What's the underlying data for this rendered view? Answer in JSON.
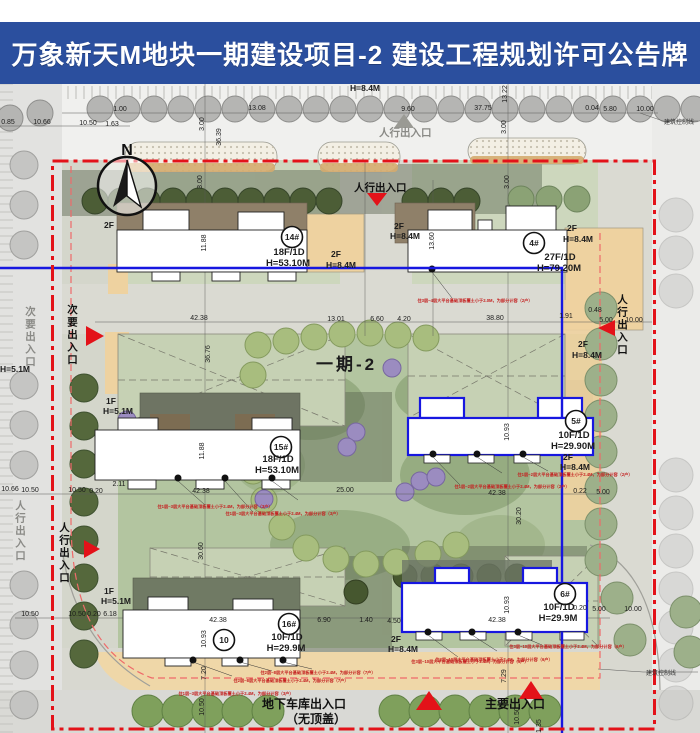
{
  "header": {
    "title": "万象新天M地块一期建设项目-2  建设工程规划许可公告牌"
  },
  "plan": {
    "phase_label": "一期-2",
    "north_label": "N",
    "colors": {
      "header_bg": "#2b4f9e",
      "boundary_red": "#e31219",
      "phase_blue": "#1717e0",
      "note_red": "#c42020",
      "tree_green": "#4c5d36",
      "annex_tan": "#eed2a0"
    },
    "buildings": [
      {
        "num": "14#",
        "floors": "18F/1D",
        "height": "H=53.10M",
        "cx": 292,
        "cy": 237,
        "tx": 289,
        "ty": 255
      },
      {
        "num": "4#",
        "floors": "27F/1D",
        "height": "H=79.20M",
        "cx": 534,
        "cy": 243,
        "tx": 560,
        "ty": 260
      },
      {
        "num": "15#",
        "floors": "18F/1D",
        "height": "H=53.10M",
        "cx": 281,
        "cy": 447,
        "tx": 278,
        "ty": 462
      },
      {
        "num": "5#",
        "floors": "10F/1D",
        "height": "H=29.90M",
        "cx": 576,
        "cy": 421,
        "tx": 574,
        "ty": 438
      },
      {
        "num": "16#",
        "floors": "10F/1D",
        "height": "H=29.9M",
        "cx": 289,
        "cy": 624,
        "tx": 287,
        "ty": 640
      },
      {
        "num": "10",
        "floors": "",
        "height": "",
        "cx": 224,
        "cy": 640,
        "tx": 0,
        "ty": 0
      },
      {
        "num": "6#",
        "floors": "10F/1D",
        "height": "H=29.9M",
        "cx": 565,
        "cy": 594,
        "tx": 559,
        "ty": 610
      }
    ],
    "unit_labels": [
      [
        "2F",
        104,
        228
      ],
      [
        "2F",
        331,
        257
      ],
      [
        "H=8.4M",
        326,
        268
      ],
      [
        "2F",
        394,
        229
      ],
      [
        "H=8.4M",
        390,
        239
      ],
      [
        "2F",
        567,
        231
      ],
      [
        "H=8.4M",
        563,
        242
      ],
      [
        "H=8.4M",
        350,
        91
      ],
      [
        "2F",
        578,
        347
      ],
      [
        "H=8.4M",
        572,
        358
      ],
      [
        "1F",
        106,
        404
      ],
      [
        "H=5.1M",
        103,
        414
      ],
      [
        "1F",
        104,
        594
      ],
      [
        "H=5.1M",
        101,
        604
      ],
      [
        "2F",
        391,
        642
      ],
      [
        "H=8.4M",
        388,
        652
      ],
      [
        "2F",
        563,
        460
      ],
      [
        "H=8.4M",
        560,
        470
      ],
      [
        "H=5.1M",
        0,
        372
      ]
    ],
    "dimensions": [
      [
        "0.85",
        8,
        124,
        0
      ],
      [
        "10.66",
        42,
        124,
        0
      ],
      [
        "10.50",
        88,
        125,
        0
      ],
      [
        "1.63",
        112,
        126,
        0
      ],
      [
        "1.00",
        120,
        111,
        0
      ],
      [
        "13.08",
        257,
        110,
        0
      ],
      [
        "36.39",
        221,
        137,
        1
      ],
      [
        "3.00",
        204,
        124,
        1
      ],
      [
        "3.00",
        202,
        182,
        1
      ],
      [
        "9.60",
        408,
        111,
        0
      ],
      [
        "37.75",
        483,
        110,
        0
      ],
      [
        "13.22",
        507,
        94,
        1
      ],
      [
        "3.00",
        506,
        127,
        1
      ],
      [
        "3.00",
        509,
        182,
        1
      ],
      [
        "0.04",
        592,
        110,
        0
      ],
      [
        "5.80",
        610,
        111,
        0
      ],
      [
        "10.00",
        645,
        111,
        0
      ],
      [
        "42.38",
        199,
        320,
        0
      ],
      [
        "13.01",
        336,
        321,
        0
      ],
      [
        "6.60",
        377,
        321,
        0
      ],
      [
        "4.20",
        404,
        321,
        0
      ],
      [
        "38.80",
        495,
        320,
        0
      ],
      [
        "1.91",
        566,
        318,
        0
      ],
      [
        "0.48",
        595,
        312,
        0
      ],
      [
        "5.00",
        606,
        322,
        0
      ],
      [
        "10.00",
        634,
        322,
        0
      ],
      [
        "11.88",
        206,
        243,
        1
      ],
      [
        "13.60",
        434,
        241,
        1
      ],
      [
        "36.76",
        210,
        354,
        1
      ],
      [
        "11.88",
        204,
        451,
        1
      ],
      [
        "10.93",
        509,
        432,
        1
      ],
      [
        "10.66",
        10,
        491,
        0
      ],
      [
        "10.50",
        30,
        492,
        0
      ],
      [
        "10.50",
        77,
        492,
        0
      ],
      [
        "0.20",
        96,
        493,
        0
      ],
      [
        "2.11",
        119,
        486,
        0
      ],
      [
        "42.38",
        201,
        493,
        0
      ],
      [
        "25.00",
        345,
        492,
        0
      ],
      [
        "42.38",
        497,
        495,
        0
      ],
      [
        "0.22",
        580,
        493,
        0
      ],
      [
        "5.00",
        603,
        494,
        0
      ],
      [
        "30.20",
        521,
        516,
        1
      ],
      [
        "30.60",
        203,
        551,
        1
      ],
      [
        "10.50",
        30,
        616,
        0
      ],
      [
        "10.50",
        77,
        616,
        0
      ],
      [
        "0.20",
        94,
        616,
        0
      ],
      [
        "6.18",
        110,
        616,
        0
      ],
      [
        "42.38",
        218,
        622,
        0
      ],
      [
        "6.90",
        324,
        622,
        0
      ],
      [
        "1.40",
        366,
        622,
        0
      ],
      [
        "4.50",
        394,
        623,
        0
      ],
      [
        "42.38",
        497,
        622,
        0
      ],
      [
        "10.93",
        206,
        639,
        1
      ],
      [
        "10.93",
        509,
        605,
        1
      ],
      [
        "0.20",
        580,
        610,
        0
      ],
      [
        "5.00",
        599,
        611,
        0
      ],
      [
        "10.00",
        633,
        611,
        0
      ],
      [
        "7.20",
        206,
        673,
        1
      ],
      [
        "10.50",
        204,
        707,
        1
      ],
      [
        "7.29",
        506,
        676,
        1
      ],
      [
        "10.50",
        519,
        716,
        1
      ],
      [
        "1.35",
        541,
        726,
        1
      ]
    ],
    "entrances": [
      {
        "text": "人行出入口",
        "x": 379,
        "y": 136,
        "vertical": false,
        "muted": true,
        "size": 10.5
      },
      {
        "text": "人行出入口",
        "x": 354,
        "y": 191,
        "vertical": false,
        "muted": false,
        "size": 10.5
      },
      {
        "text": "次要出入口",
        "x": 30,
        "y": 306,
        "vertical": true,
        "muted": true,
        "size": 10.5
      },
      {
        "text": "次要出入口",
        "x": 72,
        "y": 304,
        "vertical": true,
        "muted": false,
        "size": 10.5
      },
      {
        "text": "人行出入口",
        "x": 20,
        "y": 500,
        "vertical": true,
        "muted": true,
        "size": 10.5
      },
      {
        "text": "人行出入口",
        "x": 64,
        "y": 522,
        "vertical": true,
        "muted": false,
        "size": 10.5
      },
      {
        "text": "人行出入口",
        "x": 622,
        "y": 294,
        "vertical": true,
        "muted": false,
        "size": 10.5
      },
      {
        "text": "地下车库出入口",
        "x": 262,
        "y": 708,
        "vertical": false,
        "muted": false,
        "size": 12
      },
      {
        "text": "（无顶盖）",
        "x": 286,
        "y": 723,
        "vertical": false,
        "muted": false,
        "size": 12
      },
      {
        "text": "主要出入口",
        "x": 485,
        "y": 708,
        "vertical": false,
        "muted": false,
        "size": 12
      }
    ],
    "red_notes": [
      {
        "x": 475,
        "y": 302,
        "text": "住3层~4层大平台基础顶板覆土小于2.0M，为部分计容（2户）"
      },
      {
        "x": 215,
        "y": 508,
        "text": "住1层~3层大平台基础顶板覆土小于2.4M，为部分计容（3户）"
      },
      {
        "x": 283,
        "y": 515,
        "text": "住1层~3层大平台基础顶板覆土小于2.4M，为部分计容（3户）"
      },
      {
        "x": 575,
        "y": 476,
        "text": "住1层~2层大平台基础顶板覆土小于2.4M，为部分计容（2户）"
      },
      {
        "x": 512,
        "y": 488,
        "text": "住1层~2层大平台基础顶板覆土小于2.4M，为部分计容（2户）"
      },
      {
        "x": 470,
        "y": 663,
        "text": "住3层~10层大平台基础顶板覆土小于2.4M，为部分计容（6户）"
      },
      {
        "x": 568,
        "y": 648,
        "text": "住3层~10层大平台基础顶板覆土小于2.4M，为部分计容（6户）"
      },
      {
        "x": 494,
        "y": 661,
        "text": "住3层~10层大平台基础顶板覆土小于2.4M，为部分计容（6户）"
      },
      {
        "x": 318,
        "y": 674,
        "text": "住2层~8层大平台基础顶板覆土小于2.4M，为部分计容（7户）"
      },
      {
        "x": 291,
        "y": 682,
        "text": "住2层~8层大平台基础顶板覆土小于2.4M，为部分计容（7户）"
      },
      {
        "x": 236,
        "y": 695,
        "text": "住1层~3层大平台基础顶板覆土小于2.4M，为部分计容（3户）"
      }
    ],
    "control_line_labels": [
      {
        "text": "建筑控制线",
        "x": 664,
        "y": 124
      },
      {
        "text": "建筑控制线",
        "x": 646,
        "y": 675
      }
    ]
  }
}
